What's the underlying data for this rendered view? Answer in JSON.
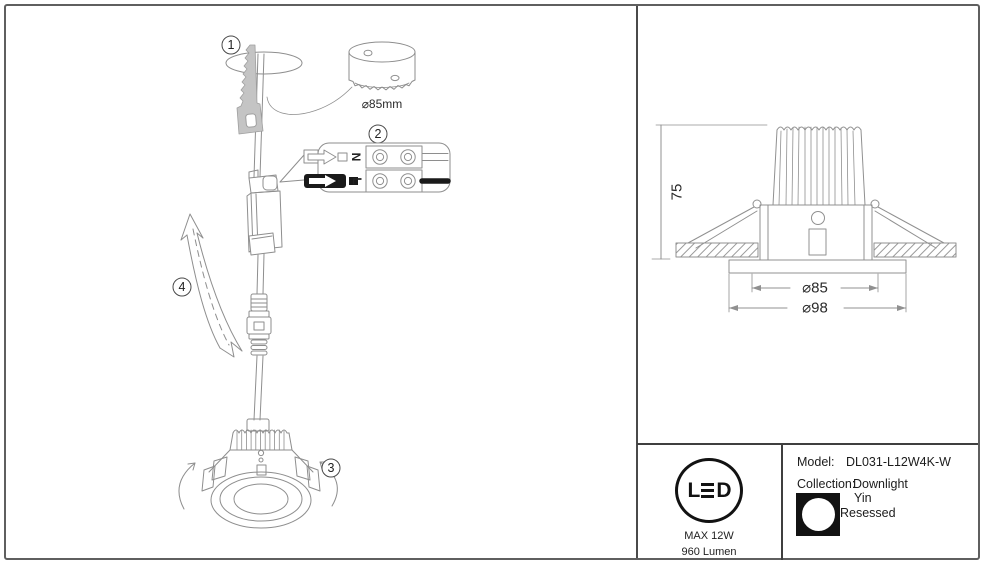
{
  "left_panel": {
    "steps": {
      "s1": "1",
      "s2": "2",
      "s3": "3",
      "s4": "4"
    },
    "hole_saw_label": "⌀85mm",
    "terminal": {
      "neutral": "N",
      "live": "L"
    }
  },
  "dimension_panel": {
    "height_label": "75",
    "cutout_diameter_label": "⌀85",
    "outer_diameter_label": "⌀98"
  },
  "info_panel": {
    "logo": {
      "text": "LED",
      "letter_l": "L",
      "letter_d": "D"
    },
    "max_power": "MAX 12W",
    "luminous_flux": "960 Lumen",
    "model_label": "Model:",
    "model_value": "DL031-L12W4K-W",
    "collection_label": "Collection:",
    "collection_value": "Downlight",
    "brand_line1": "Yin",
    "brand_line2": "Resessed"
  },
  "colors": {
    "line_gray": "#8e8e8e",
    "text_dark": "#1f1f1f",
    "frame_gray": "#5f5f5f",
    "black": "#111111"
  }
}
